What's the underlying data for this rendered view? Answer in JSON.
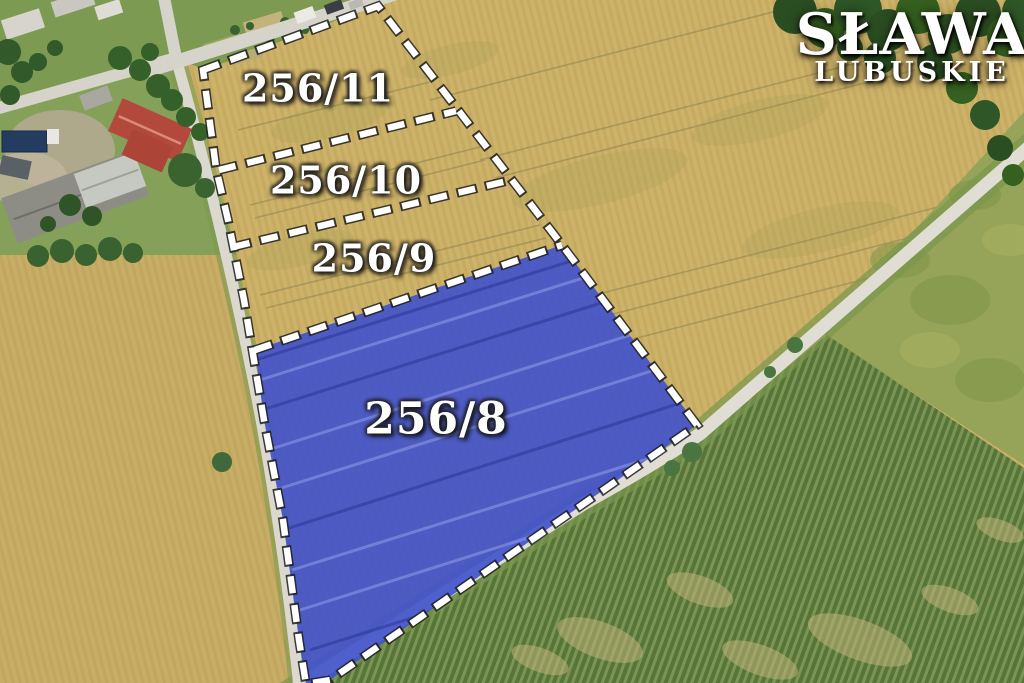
{
  "watermark": {
    "line1": "SŁAWA",
    "line2": "LUBUSKIE"
  },
  "parcels": [
    {
      "id": "256/11",
      "highlighted": false
    },
    {
      "id": "256/10",
      "highlighted": false
    },
    {
      "id": "256/9",
      "highlighted": false
    },
    {
      "id": "256/8",
      "highlighted": true
    }
  ],
  "colors": {
    "highlight_fill": "#4254cb",
    "boundary_dash": "#ffffff",
    "boundary_outline": "#1f1f1f",
    "label_text": "#ffffff",
    "wheat_field": "#cdb26a",
    "green_crop_field": "#567539",
    "road": "#dfdcd3"
  }
}
